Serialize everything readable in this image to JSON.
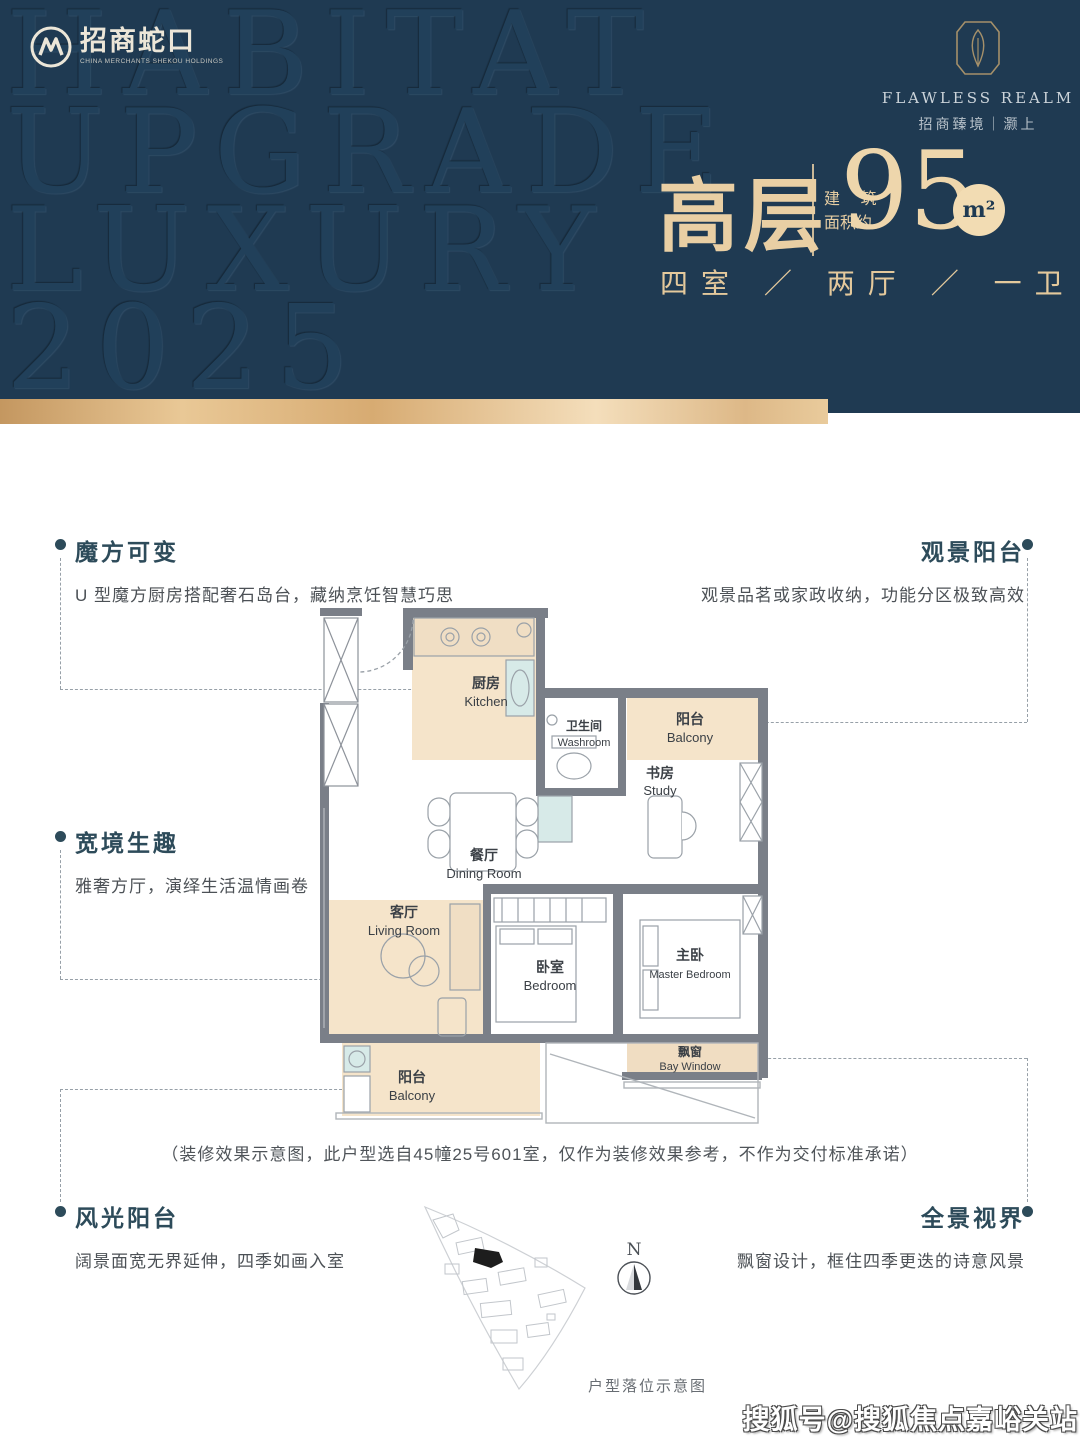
{
  "header": {
    "bg_color": "#1f3a52",
    "gold_color": "#e9c896",
    "watermark_lines": [
      "HABITAT",
      "UPGRADE",
      "LUXURY",
      "2025"
    ],
    "brand_left": {
      "name": "招商蛇口",
      "tagline": "CHINA MERCHANTS SHEKOU HOLDINGS"
    },
    "brand_right": {
      "name": "FLAWLESS REALM",
      "cn": "招商臻境｜灏上"
    },
    "title": {
      "cn": "高层",
      "area_label_line1": "建 筑",
      "area_label_line2": "面积约",
      "area_value": "95",
      "area_unit": "m²",
      "subtitle": "四室 ／ 两厅 ／ 一卫"
    }
  },
  "callouts": [
    {
      "title": "魔方可变",
      "desc": "U 型魔方厨房搭配奢石岛台，藏纳烹饪智慧巧思"
    },
    {
      "title": "观景阳台",
      "desc": "观景品茗或家政收纳，功能分区极致高效"
    },
    {
      "title": "宽境生趣",
      "desc": "雅奢方厅，演绎生活温情画卷"
    },
    {
      "title": "风光阳台",
      "desc": "阔景面宽无界延伸，四季如画入室"
    },
    {
      "title": "全景视界",
      "desc": "飘窗设计，框住四季更迭的诗意风景"
    }
  ],
  "floorplan": {
    "rooms": [
      {
        "cn": "厨房",
        "en": "Kitchen"
      },
      {
        "cn": "卫生间",
        "en": "Washroom"
      },
      {
        "cn": "阳台",
        "en": "Balcony"
      },
      {
        "cn": "书房",
        "en": "Study"
      },
      {
        "cn": "餐厅",
        "en": "Dining Room"
      },
      {
        "cn": "客厅",
        "en": "Living Room"
      },
      {
        "cn": "卧室",
        "en": "Bedroom"
      },
      {
        "cn": "主卧",
        "en": "Master Bedroom"
      },
      {
        "cn": "飘窗",
        "en": "Bay Window"
      },
      {
        "cn": "阳台",
        "en": "Balcony"
      }
    ],
    "caption": "（装修效果示意图，此户型选自45幢25号601室，仅作为装修效果参考，不作为交付标准承诺）"
  },
  "siteplan": {
    "label": "户型落位示意图",
    "compass": "N"
  },
  "watermark": "搜狐号@搜狐焦点嘉峪关站"
}
